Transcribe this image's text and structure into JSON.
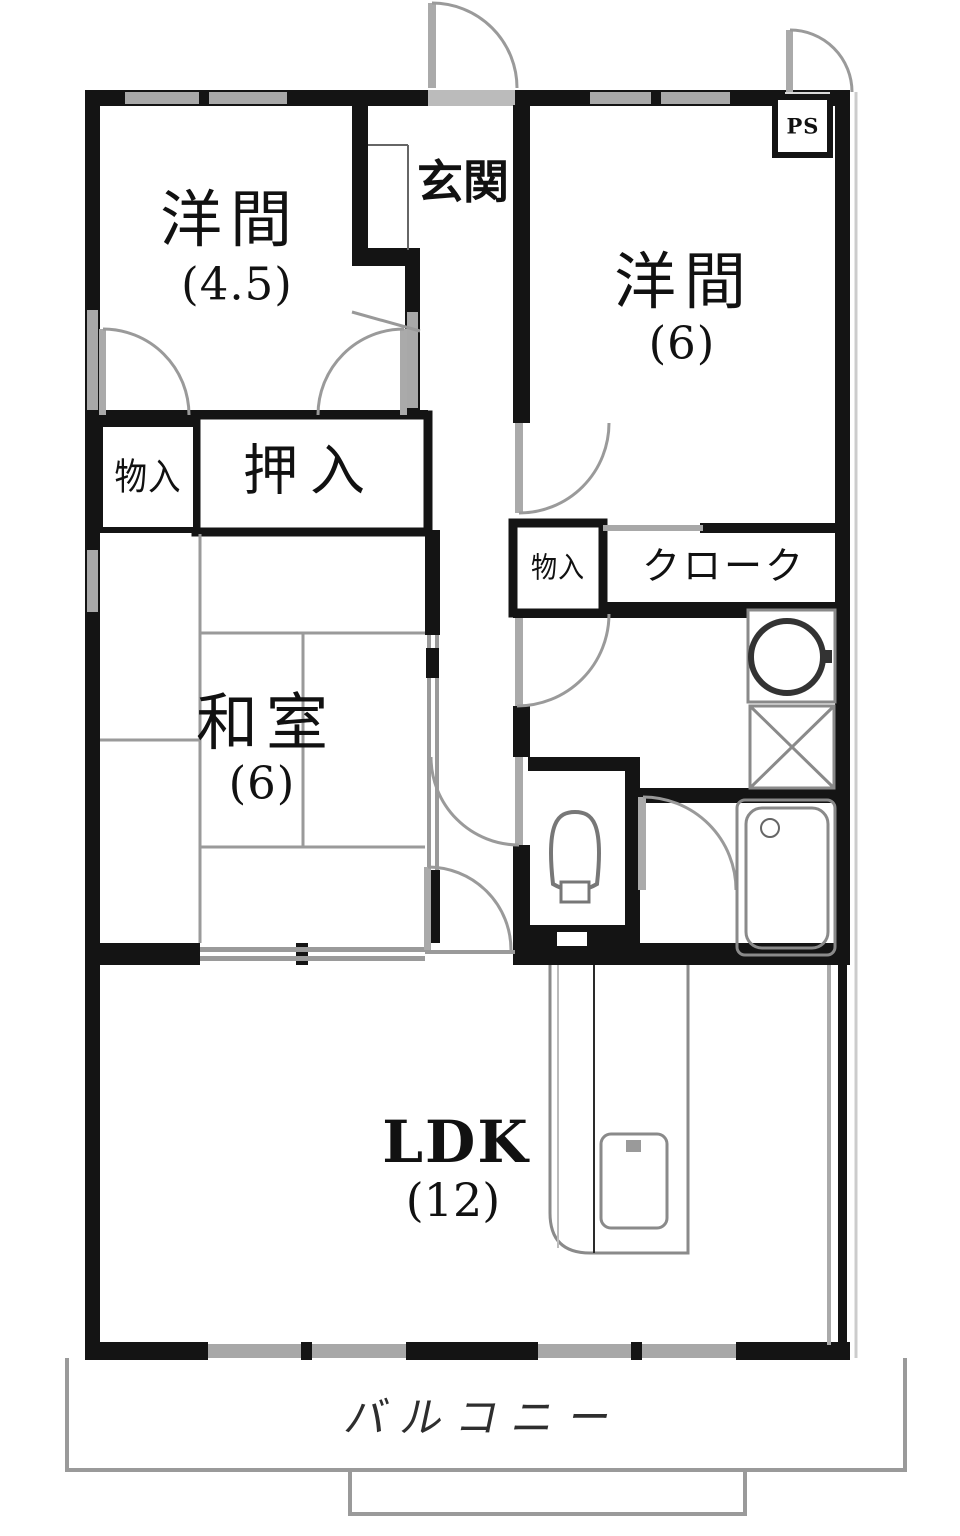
{
  "document_type": "apartment-floor-plan",
  "colors": {
    "wall": "#141414",
    "door_window_gray": "#a0a0a0",
    "fixture_gray": "#8a8a8a",
    "tatami_line_gray": "#9a9a9a",
    "background": "#ffffff"
  },
  "rooms": {
    "western_room_top_left": {
      "label": "洋間",
      "size": "(4.5)"
    },
    "entrance": {
      "label": "玄関"
    },
    "western_room_top_right": {
      "label": "洋間",
      "size": "(6)"
    },
    "pipe_space": {
      "label": "PS"
    },
    "storage_left": {
      "label": "物入"
    },
    "closet_oshiire": {
      "label": "押入"
    },
    "storage_hall": {
      "label": "物入"
    },
    "cloak": {
      "label": "クローク"
    },
    "japanese_room": {
      "label": "和室",
      "size": "(6)"
    },
    "ldk": {
      "label": "LDK",
      "size": "(12)"
    },
    "balcony": {
      "label": "バルコニー"
    }
  }
}
